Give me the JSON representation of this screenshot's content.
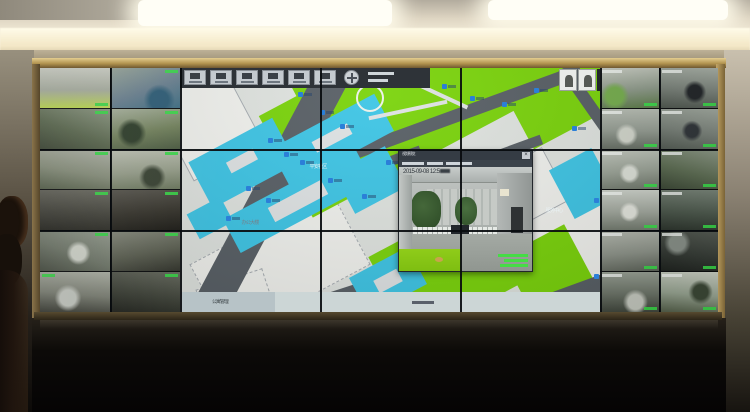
{
  "scene": {
    "colors": {
      "ceiling": "#ded5c2",
      "light_panel": "#fffef6",
      "cove_glow": "#fffbe9",
      "frame_gold": "#b2934f",
      "room_dark": "#0c0a08",
      "bezel": "#0b0d0e",
      "map_green": "#7bd40c",
      "map_cyan": "#3fc6e6",
      "map_road": "#596066",
      "map_white": "#f1f2ee",
      "map_bg": "#e0e4e0",
      "camera_label_green": "#3ade4a",
      "map_icon_blue": "#2b7fd8"
    }
  },
  "wall": {
    "vertical_bezels": [
      70,
      140,
      280,
      420,
      560,
      619
    ],
    "horizontal_bezels": [
      81,
      162
    ]
  },
  "left_cameras": [
    {
      "a": 180,
      "g": [
        "#cfd2c8",
        "#aab0a2",
        "#bfdc52"
      ],
      "lbl": "br"
    },
    {
      "a": 160,
      "g": [
        "#9aa89c",
        "#6b8292",
        "#3f7086"
      ],
      "blob": [
        "#2e5e78",
        70,
        80
      ],
      "lbl": "tr"
    },
    {
      "a": 200,
      "g": [
        "#8e9a84",
        "#5c6a50",
        "#3c4634"
      ],
      "lbl": "tr"
    },
    {
      "a": 170,
      "g": [
        "#aab4a0",
        "#74845e",
        "#4c5c42"
      ],
      "blob": [
        "#2f3f2b",
        30,
        60
      ],
      "lbl": "tr"
    },
    {
      "a": 190,
      "g": [
        "#b2b6aa",
        "#8a927e",
        "#57624c"
      ],
      "lbl": "tr"
    },
    {
      "a": 175,
      "g": [
        "#c2c6b8",
        "#9aa28e",
        "#6e7a60"
      ],
      "blob": [
        "#3a4434",
        60,
        70
      ],
      "lbl": "tr"
    },
    {
      "a": 185,
      "g": [
        "#6e6e64",
        "#46463e",
        "#282822"
      ],
      "lbl": "tr"
    },
    {
      "a": 175,
      "g": [
        "#5a5850",
        "#38362e",
        "#1e1d18"
      ],
      "lbl": "tr"
    },
    {
      "a": 200,
      "g": [
        "#9aa294",
        "#747c6e",
        "#4a5044"
      ],
      "blob": [
        "#d8dcd2",
        55,
        55
      ],
      "lbl": "tr"
    },
    {
      "a": 170,
      "g": [
        "#8a8e80",
        "#5e6254",
        "#34362e"
      ],
      "lbl": "tr"
    },
    {
      "a": 185,
      "g": [
        "#b4b8ac",
        "#82867a",
        "#3c3e36"
      ],
      "blob": [
        "#cdd1c9",
        40,
        65
      ],
      "lbl": "tl"
    },
    {
      "a": 190,
      "g": [
        "#6a6e62",
        "#42463c",
        "#23251f"
      ],
      "lbl": "tr"
    }
  ],
  "right_cameras": [
    {
      "a": 175,
      "g": [
        "#c8ccc2",
        "#8e9a8a",
        "#5a7a46"
      ],
      "blob": [
        "#76ae4e",
        25,
        70
      ],
      "ts": 1,
      "lbl": "br"
    },
    {
      "a": 185,
      "g": [
        "#aab2a8",
        "#7a827a",
        "#4e564e"
      ],
      "blob": [
        "#23272a",
        60,
        60
      ],
      "ts": 1,
      "lbl": "br"
    },
    {
      "a": 180,
      "g": [
        "#b8beb4",
        "#949c92",
        "#666e64"
      ],
      "blob": [
        "#d2d6cc",
        45,
        65
      ],
      "ts": 1,
      "lbl": "br"
    },
    {
      "a": 190,
      "g": [
        "#a2aaa0",
        "#7a827a",
        "#525a52"
      ],
      "blob": [
        "#31363a",
        55,
        55
      ],
      "ts": 1,
      "lbl": "br"
    },
    {
      "a": 175,
      "g": [
        "#c2c8be",
        "#9aa296",
        "#6e766a"
      ],
      "blob": [
        "#dde1d8",
        50,
        60
      ],
      "ts": 1,
      "lbl": "br"
    },
    {
      "a": 195,
      "g": [
        "#8e9a88",
        "#5e6e54",
        "#3a4634"
      ],
      "ts": 1,
      "lbl": "br"
    },
    {
      "a": 180,
      "g": [
        "#cdd2ca",
        "#a2a89e",
        "#727a6e"
      ],
      "blob": [
        "#e4e6de",
        50,
        55
      ],
      "ts": 1,
      "lbl": "br"
    },
    {
      "a": 185,
      "g": [
        "#7a867a",
        "#4e5a4e",
        "#2c342c"
      ],
      "ts": 1,
      "lbl": "br"
    },
    {
      "a": 175,
      "g": [
        "#b6bab0",
        "#8e948a",
        "#5e645a"
      ],
      "ts": 1,
      "lbl": "br"
    },
    {
      "a": 190,
      "g": [
        "#585e56",
        "#383e38",
        "#1f231f"
      ],
      "blob": [
        "#8a928a",
        30,
        30
      ],
      "ts": 1,
      "lbl": "br"
    },
    {
      "a": 180,
      "g": [
        "#9aa296",
        "#6e766a",
        "#42483e"
      ],
      "blob": [
        "#c8ccc2",
        60,
        75
      ],
      "ts": 1,
      "lbl": "br"
    },
    {
      "a": 185,
      "g": [
        "#cfd4c8",
        "#9aa794",
        "#55604a"
      ],
      "blob": [
        "#3e4a38",
        70,
        50
      ],
      "ts": 1,
      "lbl": "br"
    }
  ],
  "map": {
    "labels": [
      "平安社区",
      "办公大楼",
      "服务中心"
    ],
    "label_styles": [
      {
        "x": 128,
        "y": 96,
        "c": "#e9f2f4"
      },
      {
        "x": 60,
        "y": 152,
        "c": "#76808a"
      },
      {
        "x": 364,
        "y": 140,
        "c": "#e9f2f4"
      }
    ],
    "toolbar": {
      "button_count": 6
    },
    "status": {
      "left_text": "公寓管理"
    },
    "shapes": [
      {
        "f": "white",
        "cx": 28,
        "cy": 55,
        "w": 80,
        "h": 90,
        "rot": -28
      },
      {
        "f": "white",
        "cx": 100,
        "cy": 196,
        "w": 160,
        "h": 85,
        "rot": -28,
        "dash": 1
      },
      {
        "f": "white",
        "cx": 55,
        "cy": 230,
        "w": 70,
        "h": 40,
        "rot": -18,
        "dash": 1
      },
      {
        "f": "white",
        "cx": 388,
        "cy": 168,
        "w": 95,
        "h": 130,
        "rot": -28
      },
      {
        "f": "white",
        "cx": 345,
        "cy": 122,
        "w": 70,
        "h": 60,
        "rot": -28
      },
      {
        "f": "green",
        "cx": 225,
        "cy": 35,
        "w": 270,
        "h": 115,
        "rot": -28
      },
      {
        "f": "green",
        "cx": 385,
        "cy": 22,
        "w": 110,
        "h": 75,
        "rot": -28
      },
      {
        "f": "green",
        "cx": 150,
        "cy": 6,
        "w": 80,
        "h": 40,
        "rot": -28
      },
      {
        "f": "green",
        "cx": 268,
        "cy": 200,
        "w": 130,
        "h": 95,
        "rot": -28
      },
      {
        "f": "green",
        "cx": 372,
        "cy": 208,
        "w": 70,
        "h": 80,
        "rot": -28
      },
      {
        "f": "road",
        "cx": 85,
        "cy": 135,
        "w": 310,
        "h": 34,
        "rot": -62
      },
      {
        "f": "road",
        "cx": 255,
        "cy": 55,
        "w": 310,
        "h": 13,
        "rot": -20
      },
      {
        "f": "road",
        "cx": 415,
        "cy": 45,
        "w": 110,
        "h": 12,
        "rot": 55
      },
      {
        "f": "road",
        "cx": 385,
        "cy": 228,
        "w": 150,
        "h": 16,
        "rot": -20
      },
      {
        "f": "road",
        "cx": 170,
        "cy": 108,
        "w": 150,
        "h": 10,
        "rot": -20
      },
      {
        "f": "road",
        "cx": 305,
        "cy": 92,
        "w": 120,
        "h": 10,
        "rot": -20
      },
      {
        "f": "road",
        "cx": 118,
        "cy": 242,
        "w": 130,
        "h": 14,
        "rot": -18
      },
      {
        "f": "cyan",
        "cx": 62,
        "cy": 95,
        "w": 95,
        "h": 52,
        "rot": -28
      },
      {
        "f": "cyan",
        "cx": 152,
        "cy": 72,
        "w": 118,
        "h": 42,
        "rot": -28
      },
      {
        "f": "cyan",
        "cx": 118,
        "cy": 133,
        "w": 150,
        "h": 38,
        "rot": -28
      },
      {
        "f": "cyan",
        "cx": 190,
        "cy": 112,
        "w": 58,
        "h": 46,
        "rot": -28
      },
      {
        "f": "cyan",
        "cx": 403,
        "cy": 115,
        "w": 48,
        "h": 55,
        "rot": -28
      },
      {
        "f": "cyan",
        "cx": 208,
        "cy": 213,
        "w": 66,
        "h": 42,
        "rot": -28
      },
      {
        "f": "cyan",
        "cx": 30,
        "cy": 150,
        "w": 38,
        "h": 28,
        "rot": -28
      },
      {
        "f": "cyan",
        "cx": 252,
        "cy": 118,
        "w": 44,
        "h": 30,
        "rot": -28
      },
      {
        "f": "inner",
        "cx": 118,
        "cy": 133,
        "w": 60,
        "h": 16,
        "rot": -28
      },
      {
        "f": "inner",
        "cx": 152,
        "cy": 70,
        "w": 40,
        "h": 12,
        "rot": -28
      },
      {
        "f": "inner",
        "cx": 62,
        "cy": 93,
        "w": 30,
        "h": 12,
        "rot": -28
      },
      {
        "f": "inner",
        "cx": 208,
        "cy": 213,
        "w": 26,
        "h": 14,
        "rot": -28
      },
      {
        "f": "inner",
        "cx": 228,
        "cy": 42,
        "w": 80,
        "h": 4,
        "rot": -12
      },
      {
        "f": "inner",
        "cx": 262,
        "cy": 28,
        "w": 55,
        "h": 4,
        "rot": 25
      },
      {
        "f": "circle",
        "cx": 190,
        "cy": 30,
        "w": 28,
        "h": 28,
        "rot": 0
      }
    ],
    "camera_icons": [
      [
        118,
        24
      ],
      [
        140,
        42
      ],
      [
        160,
        56
      ],
      [
        88,
        70
      ],
      [
        104,
        84
      ],
      [
        120,
        92
      ],
      [
        66,
        118
      ],
      [
        86,
        130
      ],
      [
        148,
        110
      ],
      [
        46,
        148
      ],
      [
        182,
        126
      ],
      [
        262,
        16
      ],
      [
        290,
        28
      ],
      [
        322,
        34
      ],
      [
        354,
        20
      ],
      [
        392,
        58
      ],
      [
        306,
        120
      ],
      [
        414,
        130
      ],
      [
        252,
        196
      ],
      [
        205,
        236
      ],
      [
        414,
        206
      ],
      [
        318,
        234
      ],
      [
        240,
        120
      ],
      [
        206,
        92
      ]
    ]
  },
  "popup": {
    "title": "视频预览",
    "timestamp": "2015-09-08 12:5",
    "close_glyph": "×",
    "osd_line_widths": [
      30,
      24,
      28
    ]
  }
}
